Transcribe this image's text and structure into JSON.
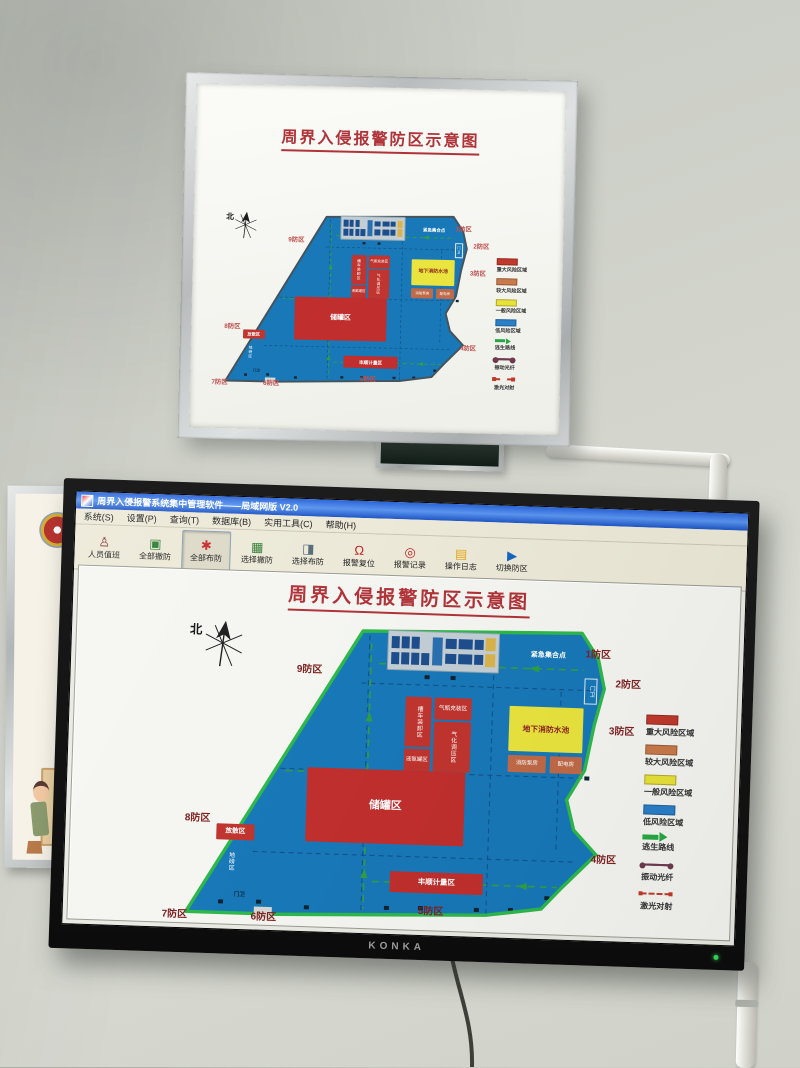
{
  "scene": {
    "no_smoking_text": "NO SMOKING",
    "tv_brand": "KONKA",
    "fire_poster": {
      "heading": "火灾",
      "lines": [
        "2、扑救",
        "发现",
        "钟内形成",
        "火灾",
        "第二灭火"
      ]
    }
  },
  "app": {
    "title": "周界入侵报警系统集中管理软件——局域网版 V2.0",
    "menu": [
      "系统(S)",
      "设置(P)",
      "查询(T)",
      "数据库(B)",
      "实用工具(C)",
      "帮助(H)"
    ],
    "toolbar": [
      {
        "label": "人员值班",
        "icon": "person-icon",
        "glyph": "♙",
        "color": "#7a2e2e",
        "active": false
      },
      {
        "label": "全部撤防",
        "icon": "disarm-all-icon",
        "glyph": "▣",
        "color": "#2e7d32",
        "active": false
      },
      {
        "label": "全部布防",
        "icon": "arm-all-icon",
        "glyph": "✱",
        "color": "#c62828",
        "active": true
      },
      {
        "label": "选择撤防",
        "icon": "disarm-select-icon",
        "glyph": "▦",
        "color": "#2e7d32",
        "active": false
      },
      {
        "label": "选择布防",
        "icon": "arm-select-icon",
        "glyph": "◨",
        "color": "#546e7a",
        "active": false
      },
      {
        "label": "报警复位",
        "icon": "alarm-reset-icon",
        "glyph": "Ω",
        "color": "#c62828",
        "active": false
      },
      {
        "label": "报警记录",
        "icon": "alarm-record-icon",
        "glyph": "◎",
        "color": "#c62828",
        "active": false
      },
      {
        "label": "操作日志",
        "icon": "operation-log-icon",
        "glyph": "▤",
        "color": "#e6a817",
        "active": false
      },
      {
        "label": "切换防区",
        "icon": "switch-zone-icon",
        "glyph": "▶",
        "color": "#1565c0",
        "active": false
      }
    ]
  },
  "diagram": {
    "title": "周界入侵报警防区示意图",
    "north_label": "北",
    "colors": {
      "site_blue": "#1878b8",
      "perimeter_green": "#2eb84b",
      "building_red": "#c0352f",
      "pool_yellow": "#e9e43e",
      "utility_orange": "#c06a48",
      "zone_label_red": "#7e2020"
    },
    "map": {
      "zone_labels": [
        {
          "label": "1防区",
          "x": 421,
          "y": 15
        },
        {
          "label": "2防区",
          "x": 452,
          "y": 44
        },
        {
          "label": "3防区",
          "x": 447,
          "y": 91
        },
        {
          "label": "4防区",
          "x": 433,
          "y": 220
        },
        {
          "label": "5防区",
          "x": 262,
          "y": 277
        },
        {
          "label": "6防区",
          "x": 95,
          "y": 288
        },
        {
          "label": "7防区",
          "x": 6,
          "y": 288
        },
        {
          "label": "8防区",
          "x": 26,
          "y": 191
        },
        {
          "label": "9防区",
          "x": 133,
          "y": 39
        }
      ],
      "buildings": [
        {
          "name": "office-complex",
          "label": "",
          "x": 223,
          "y": 6,
          "w": 112,
          "h": 40,
          "bg": "#c3ced4",
          "fg": "#123",
          "fs": 0.6,
          "vert": false,
          "kind": "complex"
        },
        {
          "name": "tanker-loading-area",
          "label": "槽车装卸区",
          "x": 243,
          "y": 72,
          "w": 26,
          "h": 50,
          "bg": "#c0352f",
          "fg": "#fff",
          "fs": 0.62,
          "vert": true
        },
        {
          "name": "cylinder-filling-area",
          "label": "气瓶充装区",
          "x": 272,
          "y": 72,
          "w": 37,
          "h": 22,
          "bg": "#c0352f",
          "fg": "#fff",
          "fs": 0.6,
          "vert": false
        },
        {
          "name": "gasification-area",
          "label": "气化调压区",
          "x": 272,
          "y": 96,
          "w": 37,
          "h": 50,
          "bg": "#c0352f",
          "fg": "#fff",
          "fs": 0.62,
          "vert": true
        },
        {
          "name": "ammonia-tank-area",
          "label": "液氨罐区",
          "x": 243,
          "y": 124,
          "w": 26,
          "h": 22,
          "bg": "#c0352f",
          "fg": "#fff",
          "fs": 0.58,
          "vert": false
        },
        {
          "name": "fire-water-pool",
          "label": "地下消防水池",
          "x": 347,
          "y": 78,
          "w": 74,
          "h": 45,
          "bg": "#e9e43e",
          "fg": "#8b1f1f",
          "fs": 0.82,
          "vert": false,
          "bold": true
        },
        {
          "name": "fire-pump-house",
          "label": "消防泵房",
          "x": 347,
          "y": 127,
          "w": 38,
          "h": 17,
          "bg": "#c06a48",
          "fg": "#fff",
          "fs": 0.58,
          "vert": false
        },
        {
          "name": "power-room",
          "label": "配电房",
          "x": 389,
          "y": 127,
          "w": 32,
          "h": 17,
          "bg": "#c06a48",
          "fg": "#fff",
          "fs": 0.58,
          "vert": false
        },
        {
          "name": "tank-farm",
          "label": "储罐区",
          "x": 147,
          "y": 146,
          "w": 158,
          "h": 74,
          "bg": "#c02f2d",
          "fg": "#fff",
          "fs": 1.15,
          "vert": false,
          "bold": true
        },
        {
          "name": "dispersal-area",
          "label": "放散区",
          "x": 58,
          "y": 205,
          "w": 38,
          "h": 16,
          "bg": "#c0352f",
          "fg": "#fff",
          "fs": 0.7,
          "vert": false,
          "bold": true
        },
        {
          "name": "metering-area",
          "label": "丰顺计量区",
          "x": 233,
          "y": 247,
          "w": 93,
          "h": 21,
          "bg": "#c02f2d",
          "fg": "#fff",
          "fs": 0.78,
          "vert": false,
          "bold": true
        }
      ],
      "office_cells": [
        [
          3,
          12,
          7,
          32,
          "#1d4e8c"
        ],
        [
          12,
          12,
          7,
          32,
          "#1d4e8c"
        ],
        [
          21,
          12,
          7,
          32,
          "#1d4e8c"
        ],
        [
          3,
          56,
          7,
          32,
          "#1d4e8c"
        ],
        [
          12,
          56,
          7,
          32,
          "#1d4e8c"
        ],
        [
          21,
          56,
          7,
          32,
          "#1d4e8c"
        ],
        [
          30,
          56,
          7,
          32,
          "#1d4e8c"
        ],
        [
          40,
          12,
          9,
          76,
          "#2a6fb0"
        ],
        [
          52,
          15,
          10,
          26,
          "#1d4e8c"
        ],
        [
          52,
          55,
          10,
          26,
          "#1d4e8c"
        ],
        [
          64,
          15,
          12,
          26,
          "#1d4e8c"
        ],
        [
          64,
          55,
          12,
          26,
          "#1d4e8c"
        ],
        [
          78,
          15,
          8,
          26,
          "#1d4e8c"
        ],
        [
          78,
          55,
          8,
          26,
          "#1d4e8c"
        ],
        [
          88,
          10,
          9,
          34,
          "#d9b44a"
        ],
        [
          88,
          52,
          9,
          34,
          "#d9b44a"
        ]
      ],
      "plain_texts": [
        {
          "name": "emergency-assembly-point",
          "label": "紧急集合点",
          "x": 352,
          "y": 21,
          "w": 64,
          "h": 12,
          "fg": "#fff",
          "fs": 0.74,
          "vert": false,
          "bold": true
        },
        {
          "name": "gate-guard-top",
          "label": "门卫",
          "x": 421,
          "y": 48,
          "w": 13,
          "h": 26,
          "fg": "#fff",
          "fs": 0.6,
          "vert": true,
          "border": true
        },
        {
          "name": "gate-guard-bottom",
          "label": "门卫",
          "x": 72,
          "y": 271,
          "w": 22,
          "h": 10,
          "fg": "#0c2940",
          "fs": 0.6,
          "vert": false,
          "bold": true
        },
        {
          "name": "weighbridge-area",
          "label": "地磅区",
          "x": 66,
          "y": 224,
          "w": 13,
          "h": 38,
          "fg": "#fff",
          "fs": 0.62,
          "vert": true
        }
      ]
    },
    "legend": [
      {
        "type": "swatch",
        "color": "#c0392b",
        "label": "重大风险区域"
      },
      {
        "type": "swatch",
        "color": "#c97a4a",
        "label": "较大风险区域"
      },
      {
        "type": "swatch",
        "color": "#e8e23a",
        "label": "一般风险区域"
      },
      {
        "type": "swatch",
        "color": "#2a7fc9",
        "label": "低风险区域"
      },
      {
        "type": "arrow",
        "color": "#27a844",
        "label": "逃生路线"
      },
      {
        "type": "fiber",
        "color": "#6d3a4e",
        "label": "振动光纤"
      },
      {
        "type": "laser",
        "color": "#c0392b",
        "label": "激光对射"
      }
    ]
  }
}
